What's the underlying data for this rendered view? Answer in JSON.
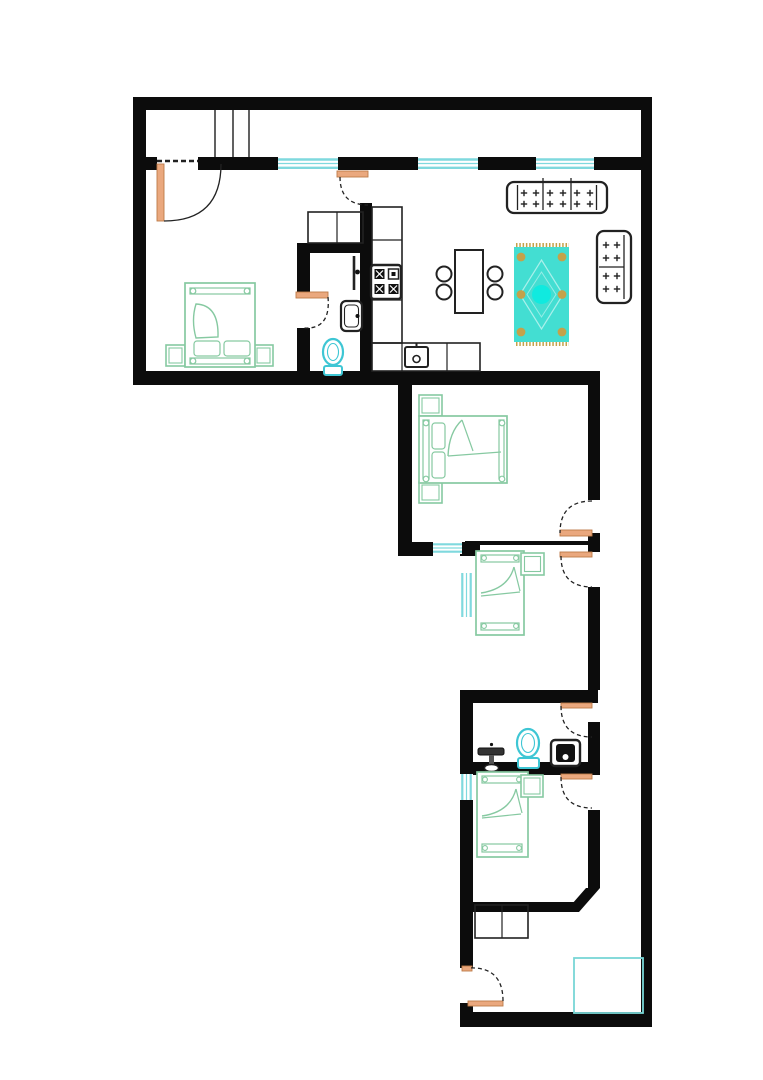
{
  "meta": {
    "type": "architectural-floor-plan",
    "visible_text": "none",
    "orientation": "L-shaped apartment, top wing horizontal, lower wing vertical with right-side corridor"
  },
  "colors": {
    "wall": "#0c0c0c",
    "line": "#222222",
    "window": "#7fd9de",
    "door": "#eaa87e",
    "doorEdge": "#bd7a48",
    "green": "#86c9a1",
    "fixture": "#3ec6d4",
    "rug": "#43ded2",
    "rugAccent": "#c4a24a",
    "rugCenter": "#10eadf",
    "zone": "#79d6d6",
    "bg": "#ffffff"
  },
  "rooms": [
    {
      "name": "balcony-strip",
      "features": [
        "three divider lines at left"
      ]
    },
    {
      "name": "master-bedroom",
      "features": [
        "double bed",
        "two nightstands",
        "balcony door"
      ]
    },
    {
      "name": "ensuite-bathroom",
      "features": [
        "toilet",
        "washbasin",
        "towel rail"
      ]
    },
    {
      "name": "kitchen",
      "features": [
        "counter run",
        "stove with 4 burners",
        "sink counter",
        "two closets"
      ]
    },
    {
      "name": "living-dining-room",
      "features": [
        "three-seat sofa",
        "two-seat sofa",
        "dining table with four chairs",
        "patterned rug"
      ]
    },
    {
      "name": "middle-bedroom",
      "features": [
        "double bed",
        "two nightstands",
        "window to outside"
      ]
    },
    {
      "name": "single-bedroom-1",
      "features": [
        "single bed",
        "bedside table",
        "left window"
      ]
    },
    {
      "name": "lower-bathroom",
      "features": [
        "pedestal sink",
        "toilet",
        "washing machine"
      ]
    },
    {
      "name": "single-bedroom-2",
      "features": [
        "single bed",
        "bedside table",
        "left window",
        "chamfered corner"
      ]
    },
    {
      "name": "corridor",
      "features": [
        "connects living room to all lower rooms"
      ]
    },
    {
      "name": "entry-hall",
      "features": [
        "entry door",
        "two closets",
        "cyan floor zone"
      ]
    }
  ],
  "openings": {
    "windows_cyan": 6,
    "door_swings_orange": 8
  },
  "furniture_colors": {
    "beds_and_tables": "green outline",
    "sofas_tables_kitchen": "black outline",
    "sanitary": "cyan outline",
    "rug": "turquoise with tan dots and fringe"
  }
}
